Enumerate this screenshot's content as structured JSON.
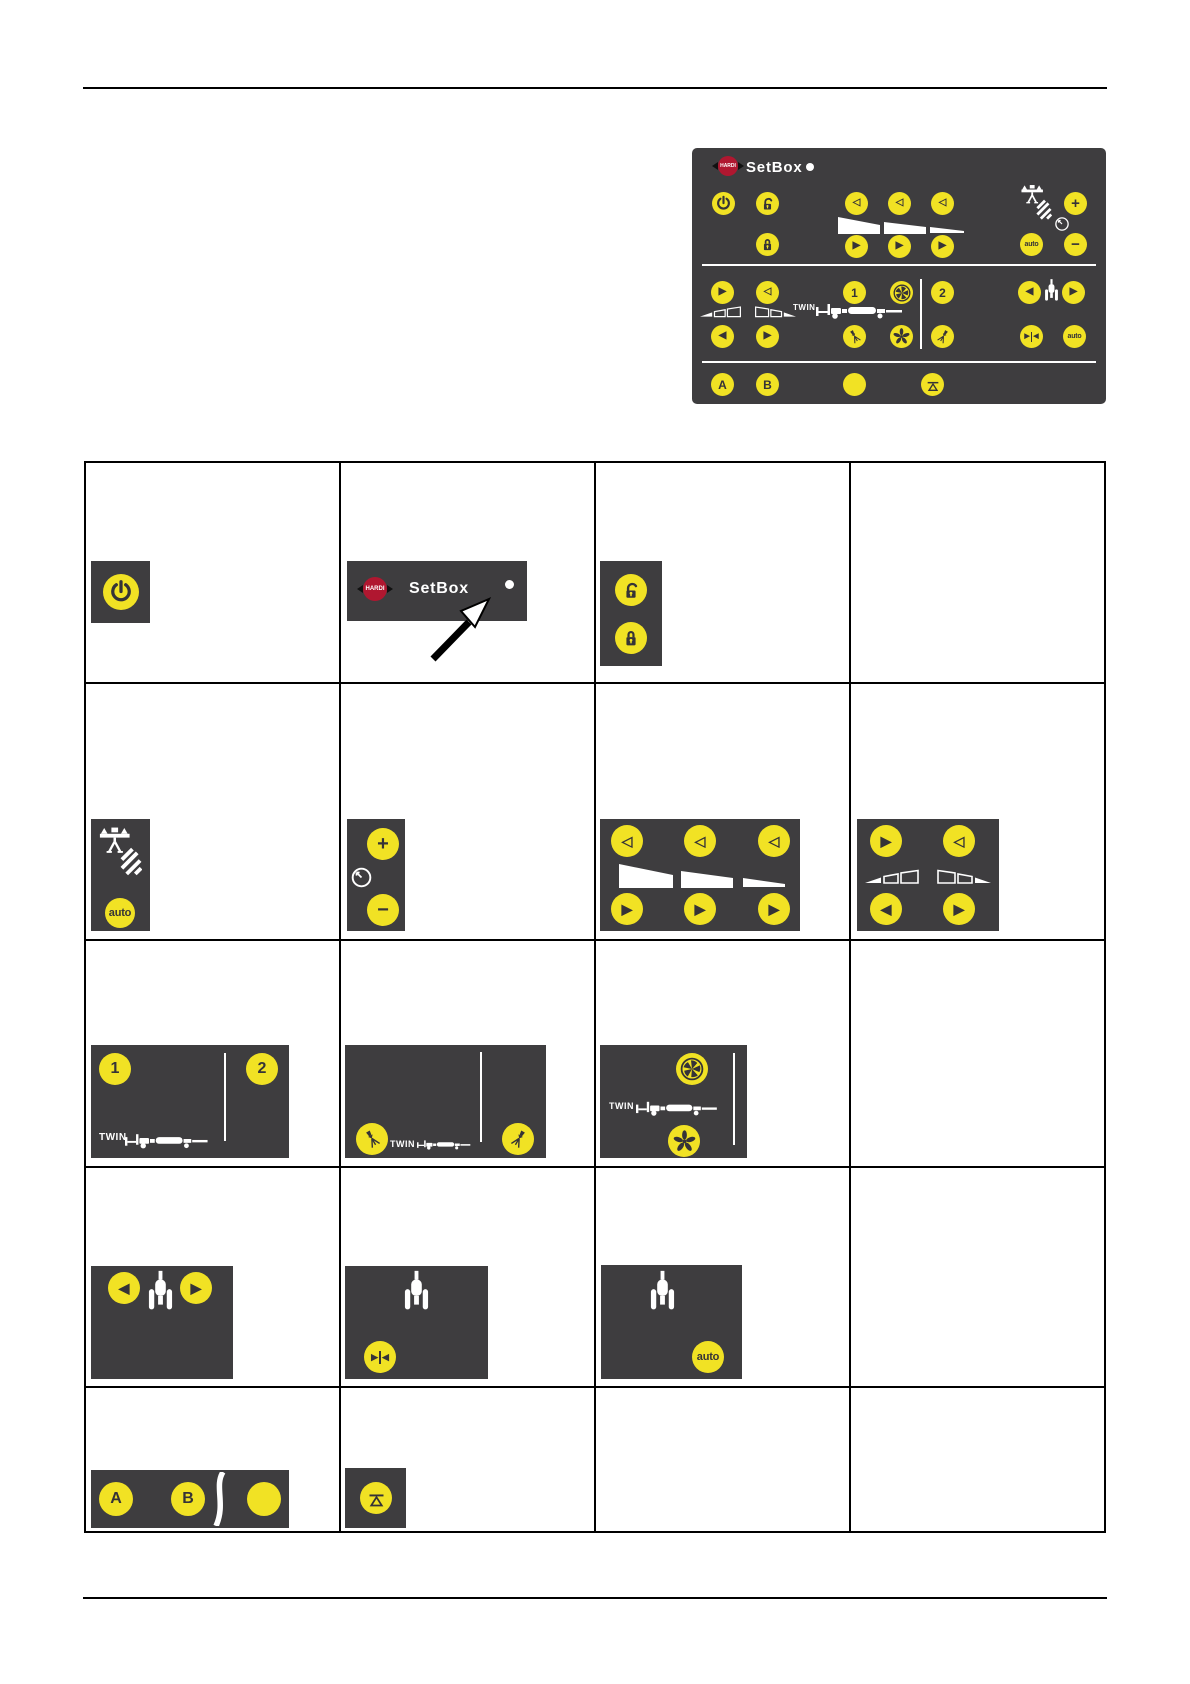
{
  "page": {
    "kind": "spray-controller manual page"
  },
  "panel": {
    "logo_text": "HARDI",
    "title": "SetBox",
    "labels": {
      "twin": "TWIN",
      "auto": "auto",
      "one": "1",
      "two": "2",
      "a": "A",
      "b": "B",
      "plus": "+",
      "minus": "−"
    }
  },
  "glyphs": {
    "tri_left": "◀",
    "tri_right": "▶",
    "tri_left_outline": "◁",
    "tri_right_outline": "▷"
  },
  "icons": {
    "power": "power-ring",
    "padlock_open": "unlock",
    "padlock_closed": "lock",
    "clock": "timer-clock",
    "fan_ring": "fan-in-circle",
    "fan_solid": "fan-blades",
    "nozzle": "spray-nozzle",
    "sprayer_rear": "sprayer-rear-view",
    "boom_height": "boom-over-crop-hatch",
    "mirror": "triangles-inward",
    "level": "line-over-triangle",
    "led": "status-led-dot"
  },
  "colors": {
    "console_bg": "#3e3d3f",
    "key_yellow": "#f1e224",
    "logo_red": "#b01730",
    "led_white": "#ffffff",
    "rule_black": "#000000"
  },
  "table": {
    "rows": 5,
    "columns": 4
  }
}
